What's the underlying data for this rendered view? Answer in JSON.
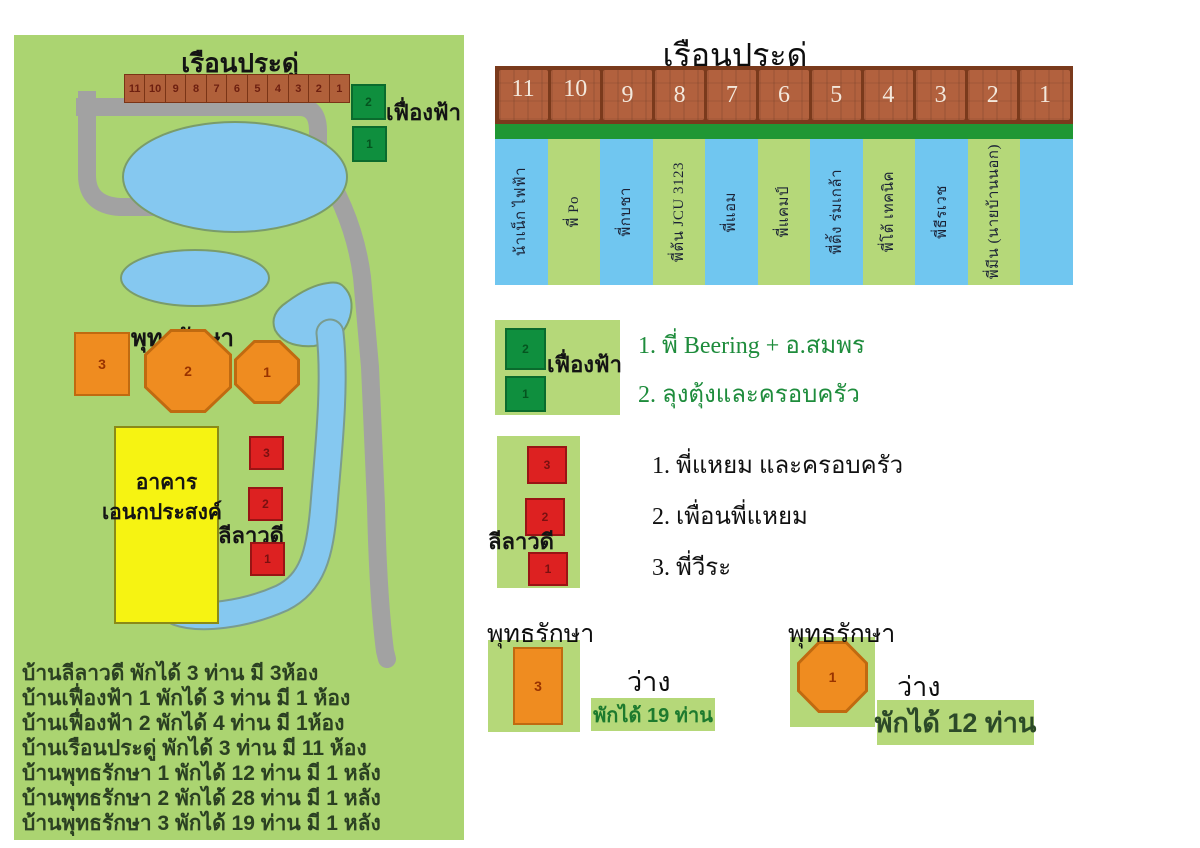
{
  "map": {
    "title": "เรือนประดู่",
    "pradu_cells": [
      "11",
      "10",
      "9",
      "8",
      "7",
      "6",
      "5",
      "4",
      "3",
      "2",
      "1"
    ],
    "fueangfa_label": "เฟื่องฟ้า",
    "fueangfa_cells": [
      "2",
      "1"
    ],
    "phuttharaksa_label": "พุทธรักษา",
    "phuttharaksa_shapes": [
      "3",
      "2",
      "1"
    ],
    "building_line1": "อาคาร",
    "building_line2": "เอนกประสงค์",
    "lilawadee_label": "ลีลาวดี",
    "lilawadee_cells": [
      "3",
      "2",
      "1"
    ],
    "notes": [
      "บ้านลีลาวดี พักได้ 3 ท่าน มี 3ห้อง",
      "บ้านเฟื่องฟ้า 1 พักได้ 3 ท่าน มี 1 ห้อง",
      "บ้านเฟื่องฟ้า 2 พักได้ 4 ท่าน มี 1ห้อง",
      "บ้านเรือนประดู่ พักได้ 3 ท่าน มี 11 ห้อง",
      "บ้านพุทธรักษา 1 พักได้ 12 ท่าน มี 1 หลัง",
      "บ้านพุทธรักษา 2 พักได้ 28 ท่าน มี 1 หลัง",
      "บ้านพุทธรักษา 3 พักได้ 19 ท่าน มี 1 หลัง"
    ]
  },
  "pradu_diagram": {
    "title": "เรือนประดู่",
    "rooms": [
      {
        "no": "11",
        "guest": "น้าเน็ก ไฟฟ้า"
      },
      {
        "no": "10",
        "guest": "พี่ Po"
      },
      {
        "no": "9",
        "guest": "พี่กบชา"
      },
      {
        "no": "8",
        "guest": "พี่ต้น JCU 3123"
      },
      {
        "no": "7",
        "guest": "พี่แอม"
      },
      {
        "no": "6",
        "guest": "พี่แคมป์"
      },
      {
        "no": "5",
        "guest": "พี่ติ้ง ร่มเกล้า"
      },
      {
        "no": "4",
        "guest": "พี่โต้ เทคนิค"
      },
      {
        "no": "3",
        "guest": "พี่ธีรเวช"
      },
      {
        "no": "2",
        "guest": "พี่มีน (นายบ้านนอก)"
      },
      {
        "no": "1",
        "guest": ""
      }
    ]
  },
  "fueangfa_legend": {
    "label": "เฟื่องฟ้า",
    "cells": [
      "2",
      "1"
    ],
    "items": [
      "1. พี่ Beering + อ.สมพร",
      "2. ลุงตุ้งและครอบครัว"
    ]
  },
  "lilawadee_legend": {
    "label": "ลีลาวดี",
    "cells": [
      "3",
      "2",
      "1"
    ],
    "items": [
      "1. พี่แหยม และครอบครัว",
      "2. เพื่อนพี่แหยม",
      "3. พี่วีระ"
    ]
  },
  "phuttharaksa3": {
    "label": "พุทธรักษา",
    "shape_no": "3",
    "vacant": "ว่าง",
    "capacity": "พักได้ 19 ท่าน"
  },
  "phuttharaksa1": {
    "label": "พุทธรักษา",
    "shape_no": "1",
    "vacant": "ว่าง",
    "capacity": "พักได้ 12 ท่าน"
  },
  "colors": {
    "map_green": "#abd471",
    "road_gray": "#a2a2a2",
    "pond_blue": "#85c8f0",
    "brick": "#b2613e",
    "brick_dark": "#7a3a1c",
    "strip_green": "#1f9734",
    "column_blue": "#70c6f0",
    "column_green": "#b5d879",
    "house_green": "#0f8f3e",
    "house_red": "#dd2121",
    "house_orange": "#ef8c20",
    "building_yellow": "#f6f312",
    "legend_text_green": "#1e8c3c",
    "capacity19_text": "#1d7a2e",
    "capacity12_text": "#2c4a28",
    "notes_text": "#2b4022"
  }
}
